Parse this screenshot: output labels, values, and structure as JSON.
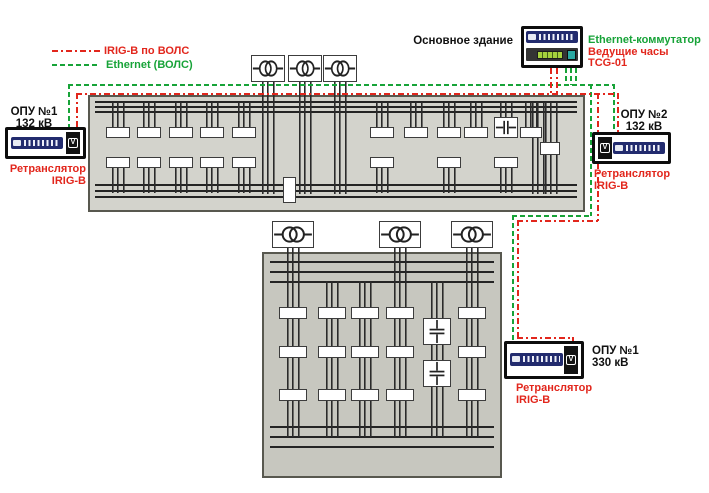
{
  "legend": {
    "irig_label": "IRIG-B по ВОЛС",
    "ethernet_label": "Ethernet (ВОЛС)"
  },
  "colors": {
    "irig_red": "#e2261c",
    "ethernet_green": "#17a338"
  },
  "main_building": {
    "label": "Основное здание",
    "switch_label": "Ethernet-коммутатор",
    "clock_label_line1": "Ведущие часы",
    "clock_label_line2": "TCG-01"
  },
  "stations": {
    "opu1_132": {
      "name": "ОПУ №1",
      "voltage": "132 кВ",
      "device_line1": "Ретранслятор",
      "device_line2": "IRIG-B"
    },
    "opu2_132": {
      "name": "ОПУ №2",
      "voltage": "132 кВ",
      "device_line1": "Ретранслятор",
      "device_line2": "IRIG-B"
    },
    "opu1_330": {
      "name": "ОПУ №1",
      "voltage": "330 кВ",
      "device_line1": "Ретранслятор",
      "device_line2": "IRIG-B"
    }
  }
}
